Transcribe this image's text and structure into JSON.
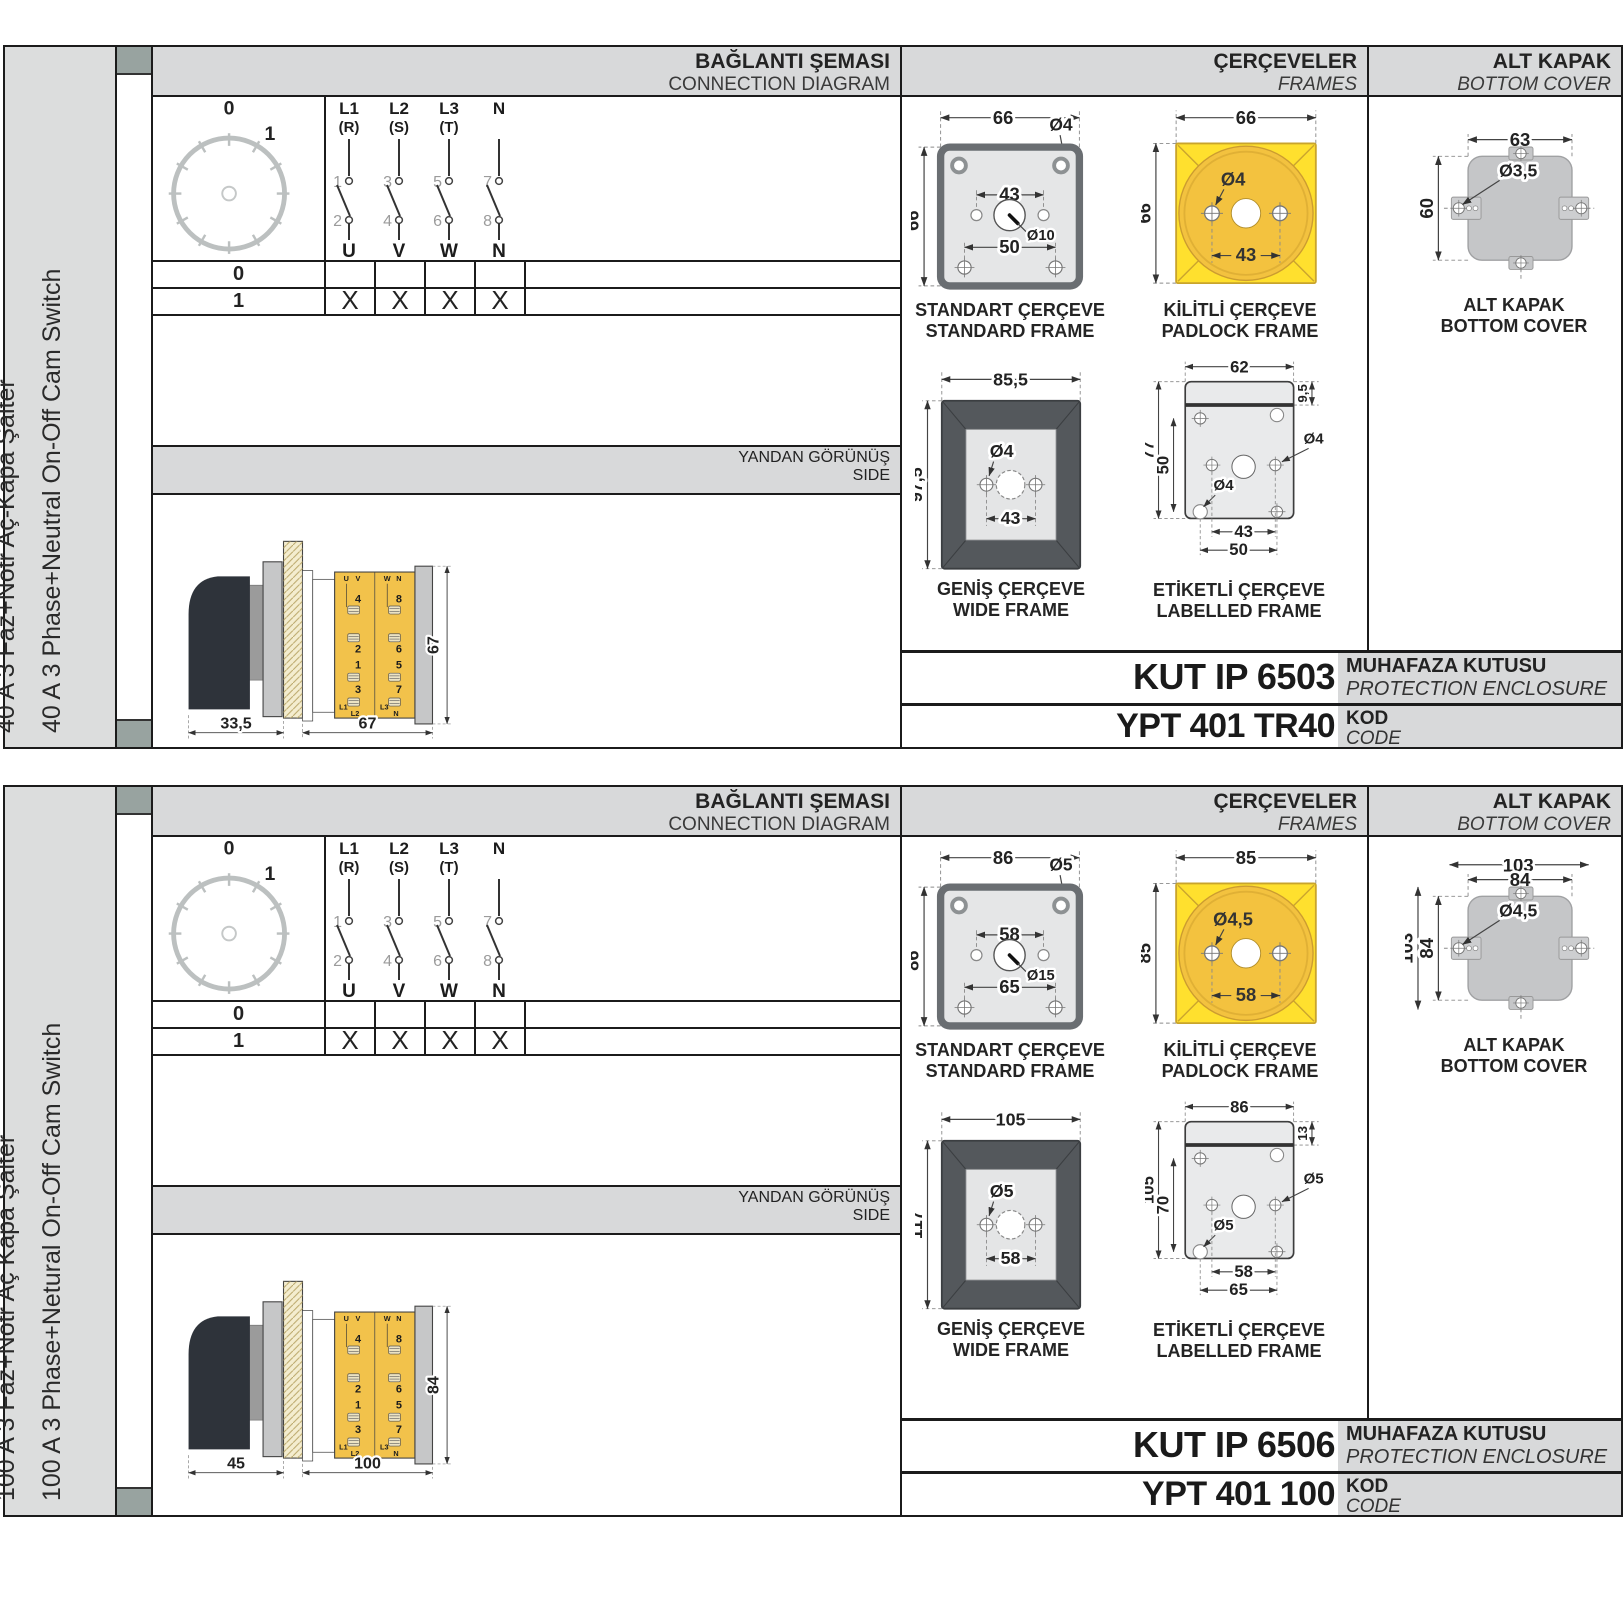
{
  "page": {
    "col_headers": {
      "connection": {
        "tr": "BAĞLANTI ŞEMASI",
        "en": "CONNECTION DIAGRAM"
      },
      "frames": {
        "tr": "ÇERÇEVELER",
        "en": "FRAMES"
      },
      "bottom_cover": {
        "tr": "ALT KAPAK",
        "en": "BOTTOM COVER"
      },
      "side": {
        "tr": "YANDAN GÖRÜNÜŞ",
        "en": "SIDE"
      }
    },
    "connection": {
      "dial": {
        "zero": "0",
        "one": "1"
      },
      "poles": [
        {
          "top1": "L1",
          "top2": "(R)",
          "t_up": "1",
          "t_dn": "2",
          "bottom": "U"
        },
        {
          "top1": "L2",
          "top2": "(S)",
          "t_up": "3",
          "t_dn": "4",
          "bottom": "V"
        },
        {
          "top1": "L3",
          "top2": "(T)",
          "t_up": "5",
          "t_dn": "6",
          "bottom": "W"
        },
        {
          "top1": "N",
          "top2": "",
          "t_up": "7",
          "t_dn": "8",
          "bottom": "N"
        }
      ],
      "table": {
        "rows": [
          {
            "pos": "0",
            "m1": "",
            "m2": "",
            "m3": "",
            "m4": ""
          },
          {
            "pos": "1",
            "m1": "X",
            "m2": "X",
            "m3": "X",
            "m4": "X"
          }
        ]
      }
    },
    "side_labels": {
      "tl1": "U",
      "tl2": "V",
      "tr1": "W",
      "tr2": "N",
      "l1": "4",
      "l2": "2",
      "l3": "1",
      "l4": "3",
      "bl1": "L1",
      "bl2": "L2",
      "r1": "8",
      "r2": "6",
      "r3": "5",
      "r4": "7",
      "br1": "L3",
      "br2": "N"
    },
    "captions": {
      "standard": {
        "tr": "STANDART ÇERÇEVE",
        "en": "STANDARD FRAME"
      },
      "padlock": {
        "tr": "KİLİTLİ ÇERÇEVE",
        "en": "PADLOCK FRAME"
      },
      "wide": {
        "tr": "GENİŞ ÇERÇEVE",
        "en": "WIDE FRAME"
      },
      "labelled": {
        "tr": "ETİKETLİ ÇERÇEVE",
        "en": "LABELLED FRAME"
      },
      "cover": {
        "tr": "ALT KAPAK",
        "en": "BOTTOM COVER"
      },
      "enclosure": {
        "tr": "MUHAFAZA KUTUSU",
        "en": "PROTECTION ENCLOSURE"
      },
      "code": {
        "tr": "KOD",
        "en": "CODE"
      }
    },
    "colors": {
      "accent_yellow": "#ffe02e",
      "body_yellow": "#f2c24b",
      "panel_gray": "#d8d9da",
      "frame_dark": "#54585c"
    }
  },
  "sections": [
    {
      "title_tr": "40 A 3 Faz+Nötr Aç-Kapa Şalter",
      "title_en": "40 A 3 Phase+Neutral On-Off Cam Switch",
      "side": {
        "depth": "33,5",
        "length": "67",
        "height": "67"
      },
      "standard": {
        "w": "66",
        "h": "66",
        "hole": "Ø4",
        "span": "43",
        "span2": "50",
        "center": "Ø10"
      },
      "padlock": {
        "w": "66",
        "h": "66",
        "hole": "Ø4",
        "span": "43"
      },
      "wide": {
        "w": "85,5",
        "h": "97,5",
        "hole": "Ø4",
        "span": "43"
      },
      "labelled": {
        "w": "62",
        "h": "77",
        "inner": "50",
        "band": "9,5",
        "hole_r": "Ø4",
        "hole_l": "Ø4",
        "span1": "43",
        "span2": "50"
      },
      "cover": {
        "w": "63",
        "h": "60",
        "hole": "Ø3,5",
        "ow": "",
        "oh": "",
        "outer_class": "hidden"
      },
      "enclosure_code": "KUT IP 6503",
      "code": "YPT 401 TR40"
    },
    {
      "title_tr": "100 A 3 Faz+Nötr Aç Kapa Şalter",
      "title_en": "100 A 3 Phase+Netural On-Off Cam Switch",
      "side": {
        "depth": "45",
        "length": "100",
        "height": "84"
      },
      "standard": {
        "w": "86",
        "h": "86",
        "hole": "Ø5",
        "span": "58",
        "span2": "65",
        "center": "Ø15"
      },
      "padlock": {
        "w": "85",
        "h": "85",
        "hole": "Ø4,5",
        "span": "58"
      },
      "wide": {
        "w": "105",
        "h": "117",
        "hole": "Ø5",
        "span": "58"
      },
      "labelled": {
        "w": "86",
        "h": "105",
        "inner": "70",
        "band": "13",
        "hole_r": "Ø5",
        "hole_l": "Ø5",
        "span1": "58",
        "span2": "65"
      },
      "cover": {
        "w": "84",
        "h": "84",
        "hole": "Ø4,5",
        "ow": "103",
        "oh": "103",
        "outer_class": ""
      },
      "enclosure_code": "KUT IP 6506",
      "code": "YPT 401 100"
    }
  ]
}
